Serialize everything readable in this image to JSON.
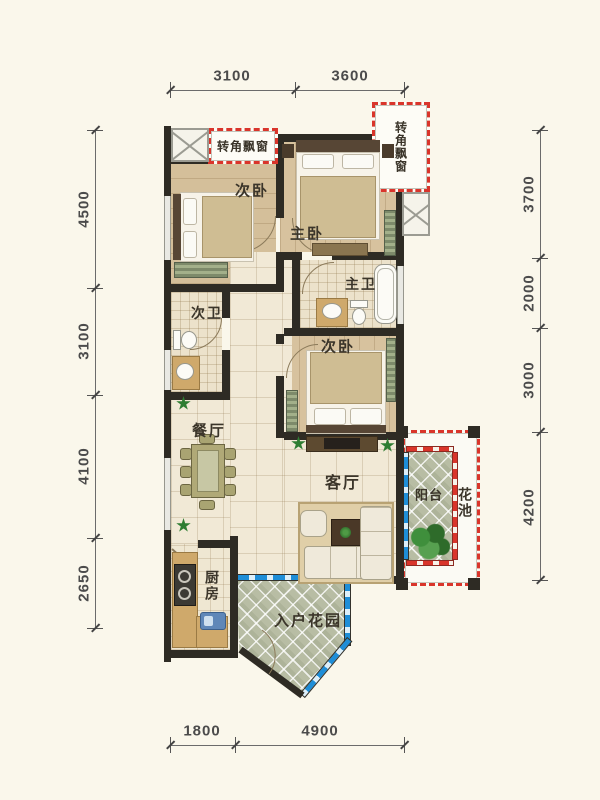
{
  "title": "apartment-floor-plan",
  "windows": {
    "corner_bay_top": "转角飘窗",
    "corner_bay_right": "转角飘窗"
  },
  "rooms": {
    "bedroom_top": "次卧",
    "master_bedroom": "主卧",
    "master_bath": "主卫",
    "second_bath": "次卫",
    "bedroom_mid": "次卧",
    "dining": "餐厅",
    "living": "客厅",
    "balcony": "阳台",
    "flower_bed": "花池",
    "kitchen": "厨房",
    "entry_garden": "入户花园"
  },
  "dimensions": {
    "top": [
      "3100",
      "3600"
    ],
    "left": [
      "4500",
      "3100",
      "4100",
      "2650"
    ],
    "right": [
      "3700",
      "2000",
      "3000",
      "4200"
    ],
    "bottom": [
      "1800",
      "4900"
    ]
  },
  "colors": {
    "background": "#faf7eb",
    "wall": "#2e2b24",
    "window_red": "#d9352b",
    "window_blue": "#1e8ed8",
    "wood_floor": "#d7c29e",
    "tile_floor": "#f1e9d6",
    "garden_tile": "#b8bda4",
    "plant_green": "#2e7d32",
    "dimension_text": "#4b4b4b"
  }
}
